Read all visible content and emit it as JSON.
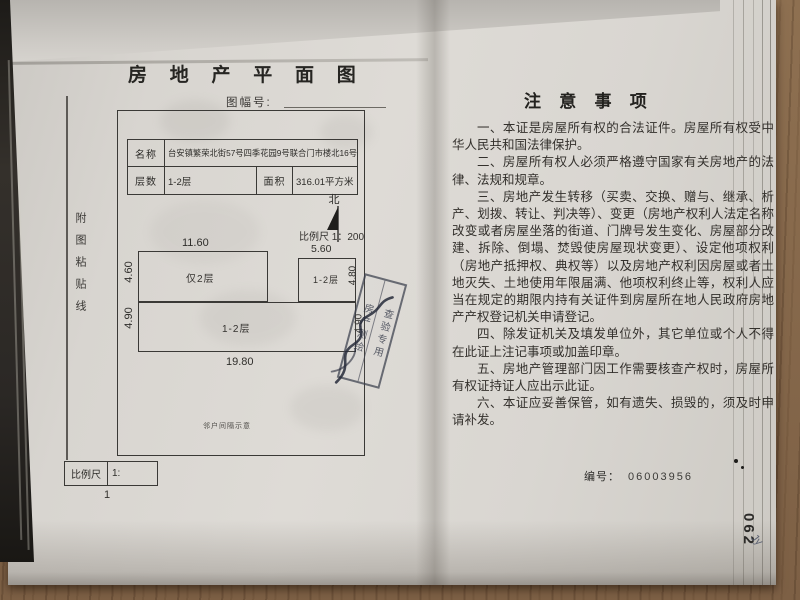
{
  "left_page": {
    "title": "房 地 产 平 面 图",
    "figure_no_label": "图幅号:",
    "paste_line_label": "附图粘贴线",
    "form": {
      "name_label": "名称",
      "name_value": "台安镇繁荣北街57号四季花园9号联合门市楼北16号门市",
      "floors_label": "层数",
      "floors_value": "1-2层",
      "area_label": "面积",
      "area_value": "316.01平方米"
    },
    "plan": {
      "north_label": "北",
      "scale_note": "比例尺 1：200",
      "dims": {
        "top_left_width": "11.60",
        "top_right_width": "5.60",
        "left_upper": "4.60",
        "left_lower": "4.90",
        "right_upper": "4.80",
        "right_lower": "4.90",
        "bottom_width": "19.80"
      },
      "rooms": {
        "upper_left": "仅2层",
        "upper_right": "1-2层",
        "lower": "1-2层"
      },
      "note": "邻户间隔示意"
    },
    "scale_box": {
      "label": "比例尺",
      "value": "1:"
    },
    "page_number": "1"
  },
  "right_page": {
    "title": "注 意 事 项",
    "paragraphs": [
      "一、本证是房屋所有权的合法证件。房屋所有权受中华人民共和国法律保护。",
      "二、房屋所有权人必须严格遵守国家有关房地产的法律、法规和规章。",
      "三、房地产发生转移（买卖、交换、赠与、继承、析产、划拨、转让、判决等）、变更（房地产权利人法定名称改变或者房屋坐落的街道、门牌号发生变化、房屋部分改建、拆除、倒塌、焚毁使房屋现状变更）、设定他项权利（房地产抵押权、典权等）以及房地产权利因房屋或者土地灭失、土地使用年限届满、他项权利终止等，权利人应当在规定的期限内持有关证件到房屋所在地人民政府房地产产权登记机关申请登记。",
      "四、除发证机关及填发单位外，其它单位或个人不得在此证上注记事项或加盖印章。",
      "五、房地产管理部门因工作需要核查产权时，房屋所有权证持证人应出示此证。",
      "六、本证应妥善保管，如有遗失、损毁的，须及时申请补发。"
    ],
    "serial_label": "编号：",
    "serial_value": "06003956",
    "side_page_code": "062",
    "handwritten_mark": "Jy"
  },
  "stamp": {
    "column_1": "房产测绘",
    "column_2": "查验专用"
  }
}
